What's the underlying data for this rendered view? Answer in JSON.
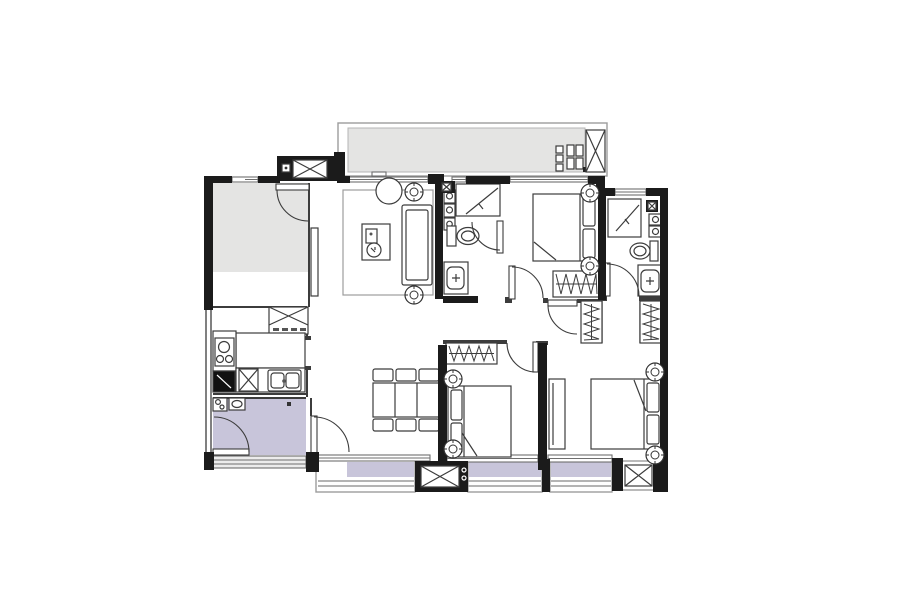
{
  "document": {
    "type": "residential-floor-plan",
    "description": "black line-work apartment floor plan with gray and lavender floor fills, no text labels"
  },
  "colors": {
    "background": "#ffffff",
    "wall": "#1b1b1b",
    "line_strong": "#3c3c3c",
    "line_mid": "#6e6e6e",
    "line_light": "#9c9c9c",
    "room_gray": "#e4e4e3",
    "room_purple": "#c8c5da",
    "sill_gray": "#ececec",
    "fixture_white": "#ffffff",
    "dark_fixture": "#111111"
  },
  "regions": [
    {
      "name": "balcony-top",
      "fill": "gray"
    },
    {
      "name": "utility-platform-top-left",
      "fill": "black-crossbox"
    },
    {
      "name": "multipurpose-room",
      "fill": "gray"
    },
    {
      "name": "kitchen",
      "fill": "white"
    },
    {
      "name": "entry-foyer",
      "fill": "purple"
    },
    {
      "name": "living-room",
      "fill": "white"
    },
    {
      "name": "dining-area",
      "fill": "white"
    },
    {
      "name": "master-bedroom",
      "fill": "white"
    },
    {
      "name": "ensuite-bathroom",
      "fill": "white"
    },
    {
      "name": "bathroom",
      "fill": "white"
    },
    {
      "name": "hallway",
      "fill": "white"
    },
    {
      "name": "bedroom-2",
      "fill": "white"
    },
    {
      "name": "bedroom-3",
      "fill": "white"
    },
    {
      "name": "ac-platform-bottom",
      "fill": "black-crossbox"
    },
    {
      "name": "balcony-strip-left",
      "fill": "purple"
    },
    {
      "name": "balcony-strip-center",
      "fill": "purple"
    },
    {
      "name": "balcony-strip-right",
      "fill": "purple"
    }
  ],
  "symbols": [
    "ceiling-fixture",
    "ac-unit-crossbox",
    "door-swing",
    "wardrobe-zigzag",
    "shower-glass",
    "double-bed",
    "dining-set",
    "sofa",
    "stove",
    "sink",
    "toilet",
    "vanity",
    "refrigerator",
    "washer-stack",
    "drying-rack"
  ]
}
